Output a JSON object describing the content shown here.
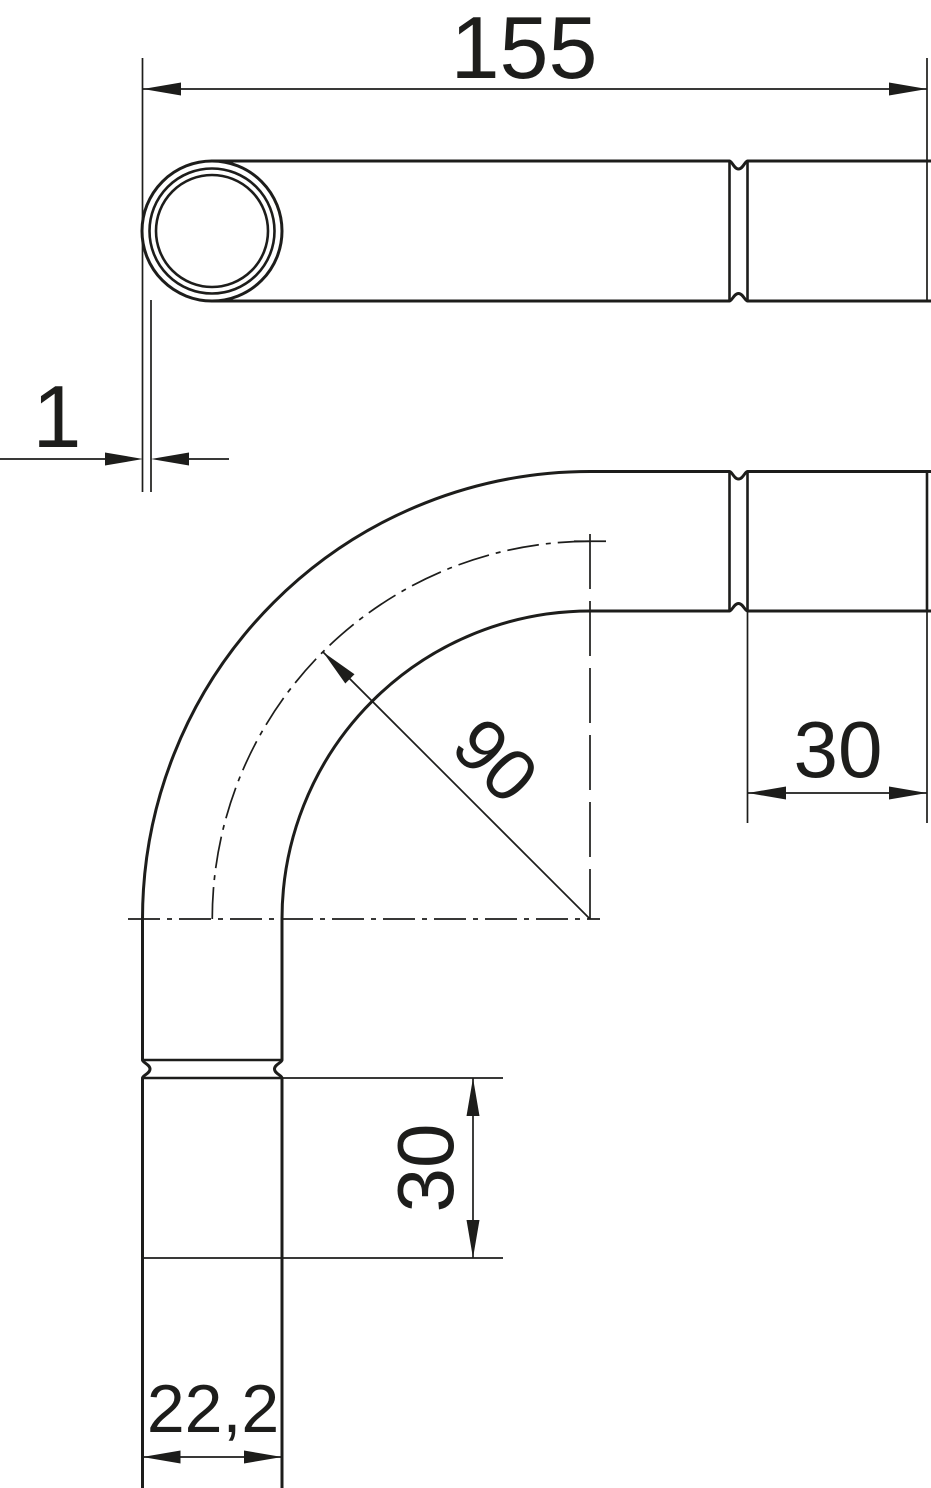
{
  "drawing": {
    "title": "90 degree pipe bend with sockets - dimensioned technical drawing",
    "background_color": "#ffffff",
    "line_color": "#1d1d1b",
    "dimensions": {
      "overall_length": {
        "label": "155"
      },
      "wall_thickness": {
        "label": "1"
      },
      "bend_radius": {
        "label": "90"
      },
      "socket_length_horizontal": {
        "label": "30"
      },
      "socket_length_vertical": {
        "label": "30"
      },
      "outer_diameter": {
        "label": "22,2"
      }
    }
  }
}
